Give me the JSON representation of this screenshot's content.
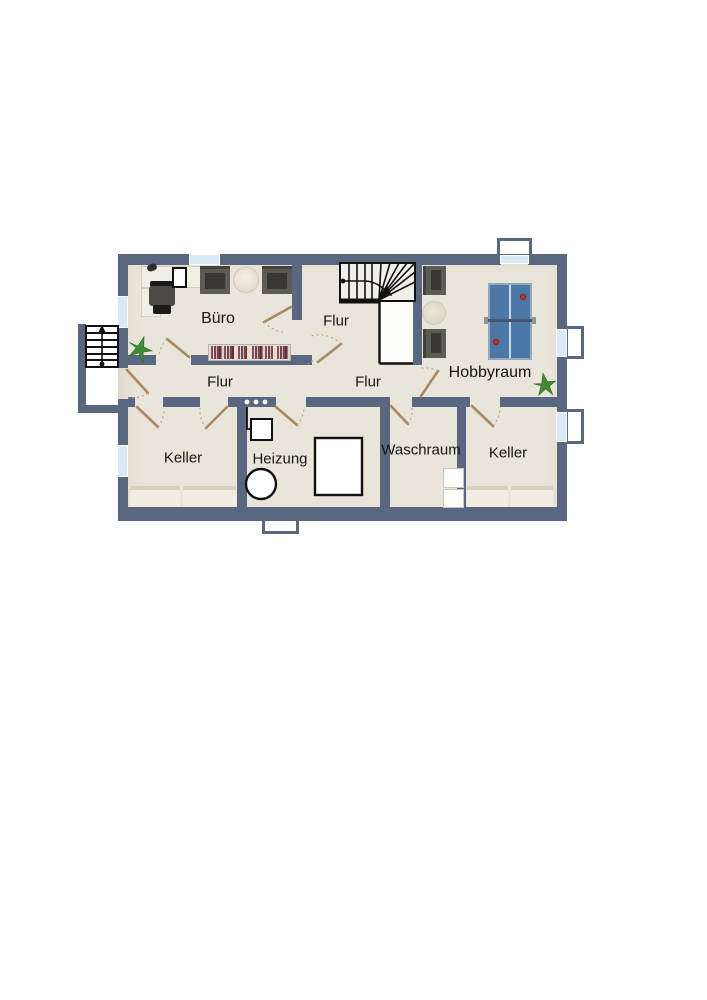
{
  "plan": {
    "type": "basement-floor-plan",
    "rooms": [
      {
        "key": "buero",
        "label": "Büro"
      },
      {
        "key": "flur-top",
        "label": "Flur"
      },
      {
        "key": "flur-west",
        "label": "Flur"
      },
      {
        "key": "flur-east",
        "label": "Flur"
      },
      {
        "key": "hobbyraum",
        "label": "Hobbyraum"
      },
      {
        "key": "keller-west",
        "label": "Keller"
      },
      {
        "key": "heizung",
        "label": "Heizung"
      },
      {
        "key": "waschraum",
        "label": "Waschraum"
      },
      {
        "key": "keller-east",
        "label": "Keller"
      }
    ],
    "icons": [
      "exterior-stairs-icon",
      "winder-stairs-icon",
      "desk-icon",
      "office-chair-icon",
      "armchair-icon",
      "coffee-table-icon",
      "bookshelf-icon",
      "plant-icon",
      "table-tennis-table-icon",
      "boiler-icon",
      "heating-tank-icon",
      "electrical-box-icon",
      "meter-panel-icon",
      "washing-machine-icon",
      "storage-shelf-icon",
      "window-icon",
      "door-icon"
    ],
    "colors": {
      "wall": "#5a6780",
      "floor": "#eae5da",
      "window_glass": "#d9eaf5",
      "door_leaf": "#a9885f",
      "table_tennis_blue": "#4b78a6",
      "plant_green": "#3e8d33",
      "ball_red": "#d42b20",
      "stair_line": "#111111"
    }
  }
}
